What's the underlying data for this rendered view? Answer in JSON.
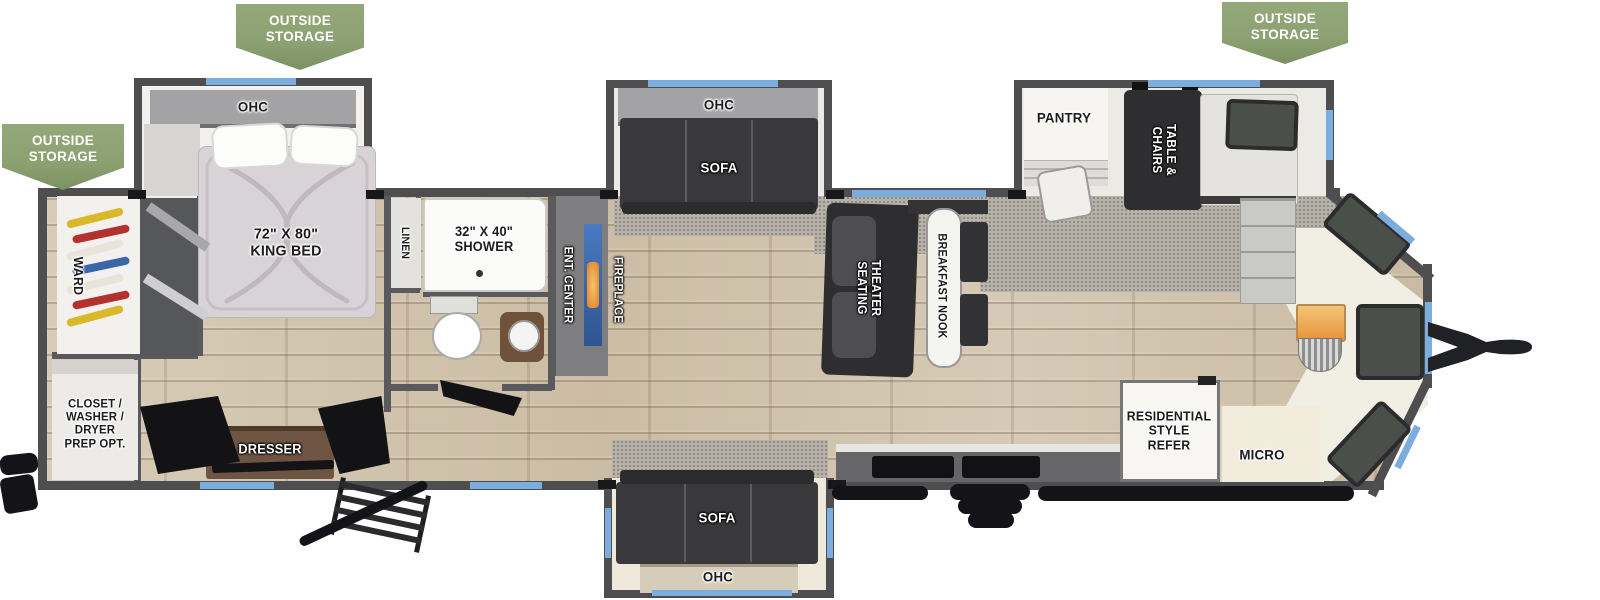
{
  "badge": {
    "label": "OUTSIDE\nSTORAGE"
  },
  "bedroom": {
    "ohc": "OHC",
    "king_bed": "72\" X 80\"\nKING BED",
    "ward": "WARD",
    "closet": "CLOSET /\nWASHER /\nDRYER\nPREP OPT.",
    "dresser": "DRESSER"
  },
  "bathroom": {
    "linen": "LINEN",
    "shower": "32\" X 40\"\nSHOWER"
  },
  "living": {
    "ent_center": "ENT. CENTER",
    "fireplace": "FIREPLACE",
    "ohc": "OHC",
    "sofa": "SOFA",
    "theater": "THEATER\nSEATING",
    "breakfast_nook": "BREAKFAST NOOK"
  },
  "kitchen": {
    "pantry": "PANTRY",
    "table_chairs": "TABLE &\nCHAIRS",
    "refrigerator": "RESIDENTIAL\nSTYLE\nREFER",
    "micro": "MICRO"
  },
  "colors": {
    "badge_green": "#8ca171",
    "wall_gray": "#4e4e51",
    "window_blue": "#7badde",
    "floor_wood": "#d3c7b2",
    "carpet_gray": "#b7b2aa",
    "flame_orange": "#e8923b"
  }
}
